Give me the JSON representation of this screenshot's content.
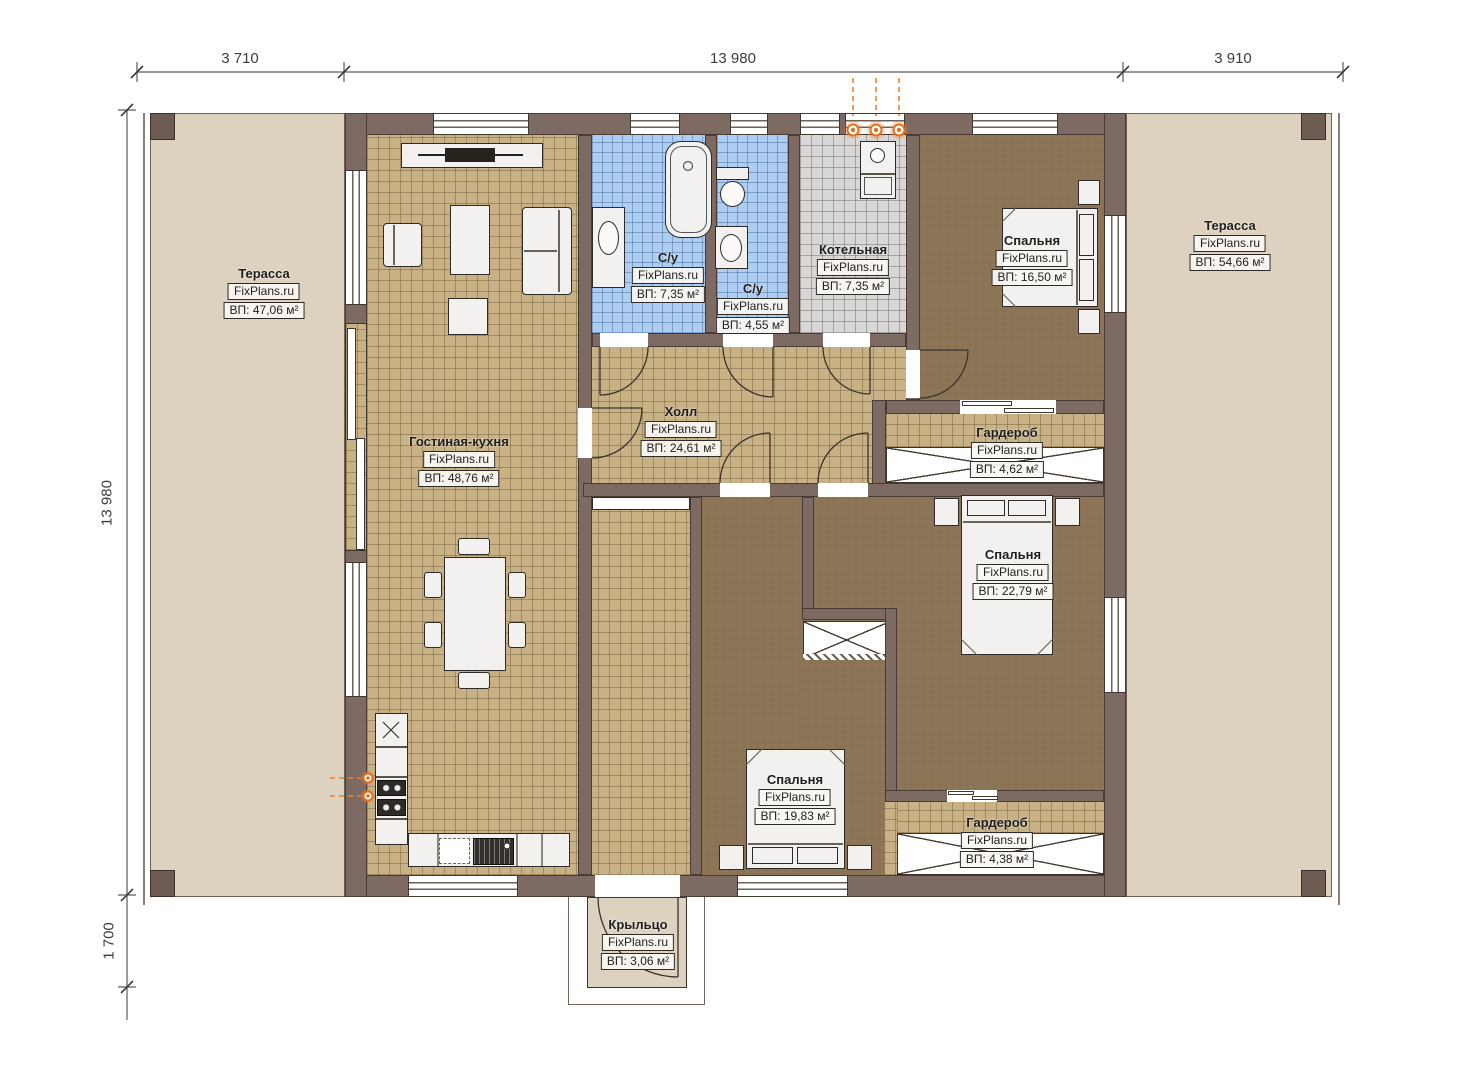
{
  "title": "План этажа",
  "watermark": "FixPlans.ru",
  "dimensions": {
    "top": [
      "3 710",
      "13 980",
      "3 910"
    ],
    "left": [
      "13 980",
      "1 700"
    ]
  },
  "rooms": [
    {
      "id": "terrace-left",
      "name": "Терасса",
      "area": "ВП: 47,06 м²"
    },
    {
      "id": "living-kitchen",
      "name": "Гостиная-кухня",
      "area": "ВП: 48,76 м²"
    },
    {
      "id": "bathroom-1",
      "name": "С/у",
      "area": "ВП: 7,35 м²"
    },
    {
      "id": "bathroom-2",
      "name": "С/у",
      "area": "ВП: 4,55 м²"
    },
    {
      "id": "boiler-room",
      "name": "Котельная",
      "area": "ВП: 7,35 м²"
    },
    {
      "id": "bedroom-1",
      "name": "Спальня",
      "area": "ВП: 16,50 м²"
    },
    {
      "id": "terrace-right",
      "name": "Терасса",
      "area": "ВП: 54,66 м²"
    },
    {
      "id": "hall",
      "name": "Холл",
      "area": "ВП: 24,61 м²"
    },
    {
      "id": "wardrobe-1",
      "name": "Гардероб",
      "area": "ВП: 4,62 м²"
    },
    {
      "id": "bedroom-2",
      "name": "Спальня",
      "area": "ВП: 22,79 м²"
    },
    {
      "id": "bedroom-3",
      "name": "Спальня",
      "area": "ВП: 19,83 м²"
    },
    {
      "id": "wardrobe-2",
      "name": "Гардероб",
      "area": "ВП: 4,38 м²"
    },
    {
      "id": "porch",
      "name": "Крыльцо",
      "area": "ВП: 3,06 м²"
    }
  ],
  "icons": {
    "gas_flame": "gas-flame-icon",
    "gas_point": "gas-point-icon"
  },
  "colors": {
    "wall": "#7c6a63",
    "terrace": "#ddd2bf",
    "tile_tan": "#c8b185",
    "tile_blue": "#aecdf2",
    "tile_gray": "#d8d7d5",
    "bedroom_floor": "#8b7355",
    "accent_orange": "#e0711f"
  }
}
